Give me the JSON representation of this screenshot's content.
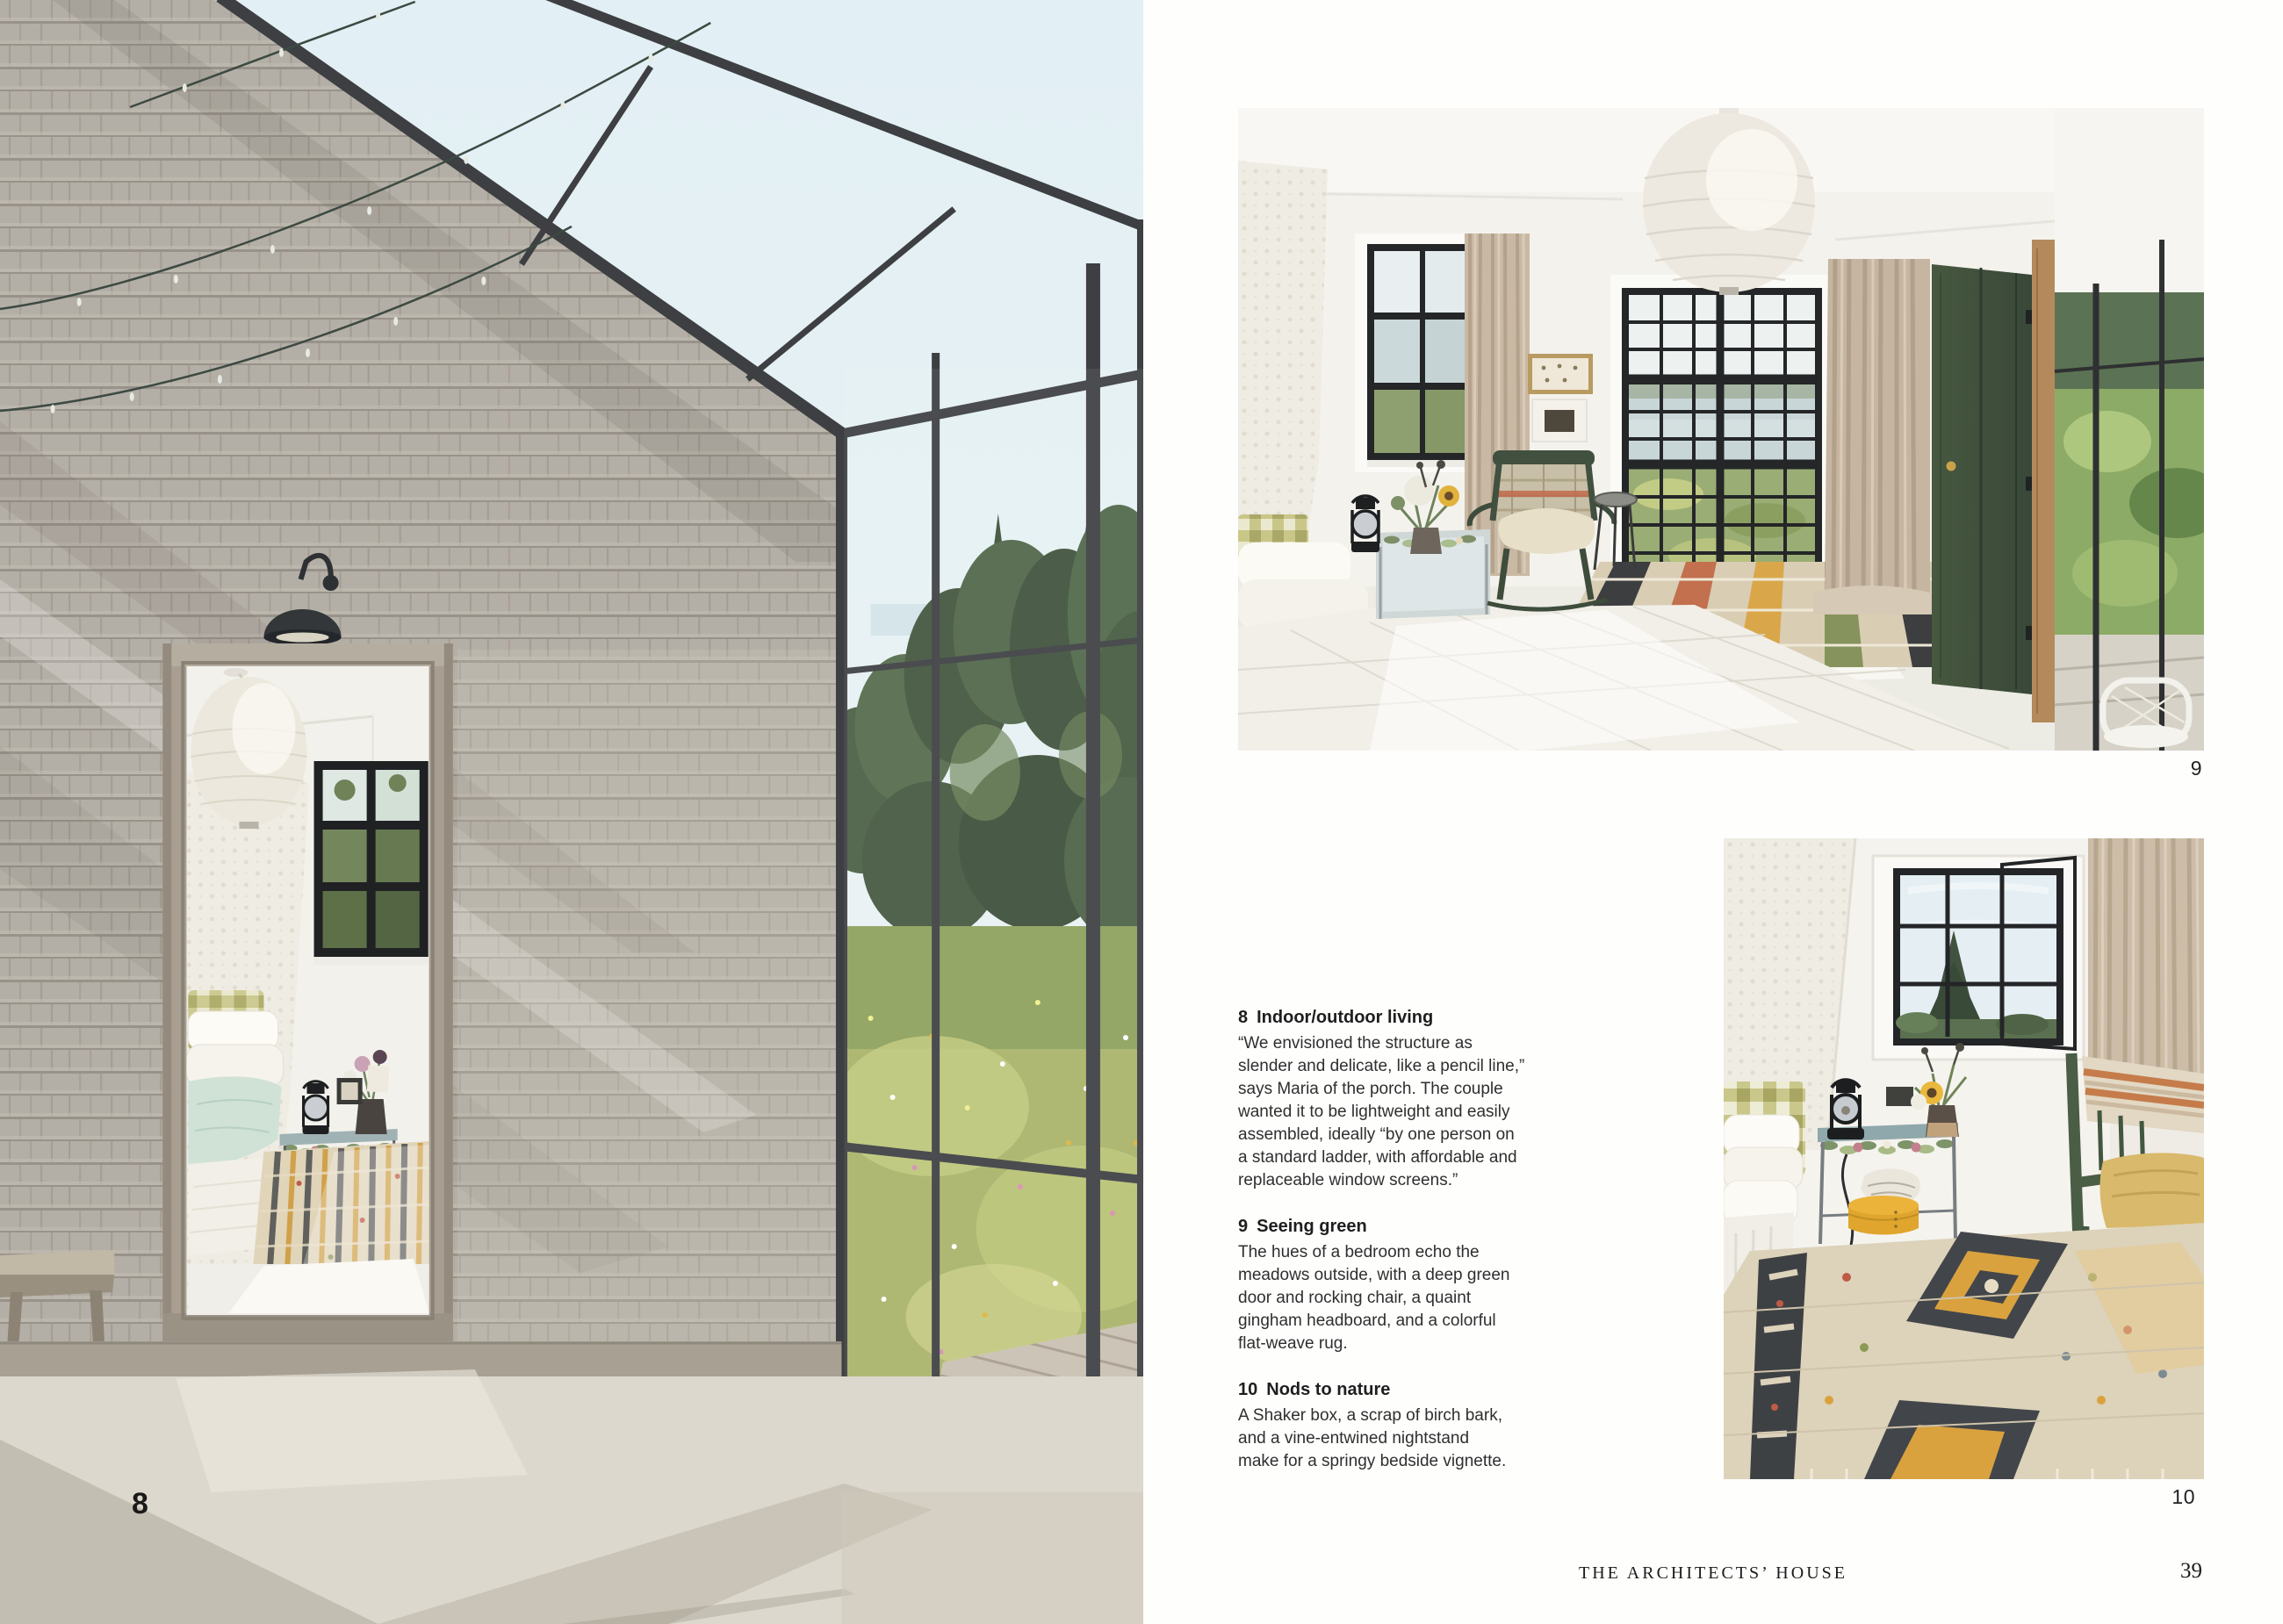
{
  "spread": {
    "left_page": {
      "figure_label": "8"
    },
    "right_page": {
      "figures": [
        {
          "label": "9"
        },
        {
          "label": "10"
        }
      ],
      "captions": [
        {
          "number": "8",
          "title": "Indoor/outdoor living",
          "body": "“We envisioned the structure as\nslender and delicate, like a pencil line,”\nsays Maria of the porch. The couple\nwanted it to be lightweight and easily\nassembled, ideally “by one person on\na standard ladder, with affordable and\nreplaceable window screens.”"
        },
        {
          "number": "9",
          "title": "Seeing green",
          "body": "The hues of a bedroom echo the\nmeadows outside, with a deep green\ndoor and rocking chair, a quaint\ngingham headboard, and a colorful\nflat-weave rug."
        },
        {
          "number": "10",
          "title": "Nods to nature",
          "body": "A Shaker box, a scrap of birch bark,\nand a vine-entwined nightstand\nmake for a springy bedside vignette."
        }
      ],
      "footer": {
        "book_title": "THE ARCHITECTS’ HOUSE",
        "page_number": "39"
      }
    },
    "palette": {
      "door_green": "#3F5142",
      "shingle_gray": "#B4AFA6",
      "curtain_beige": "#C9B9A4",
      "rug_mustard": "#D9A23F",
      "rug_charcoal": "#3E4144",
      "text": "#2F2F2F"
    }
  }
}
